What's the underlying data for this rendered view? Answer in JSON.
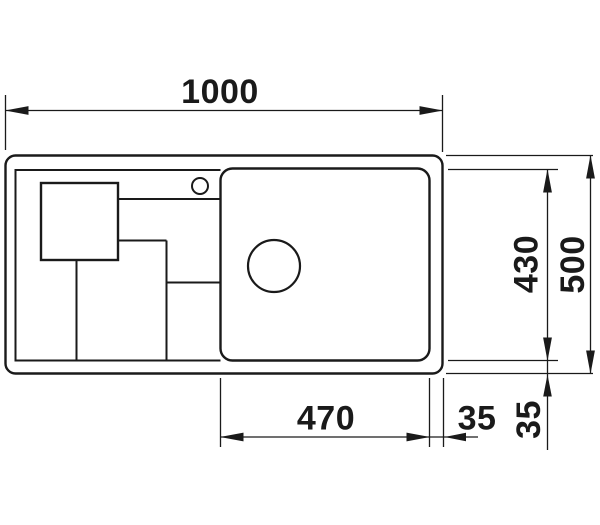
{
  "dims": {
    "overall_width": "1000",
    "overall_depth": "500",
    "inner_depth": "430",
    "bowl_width": "470",
    "rim_right": "35",
    "rim_bottom": "35"
  },
  "colors": {
    "line": "#1a1a1a",
    "background": "#ffffff"
  }
}
